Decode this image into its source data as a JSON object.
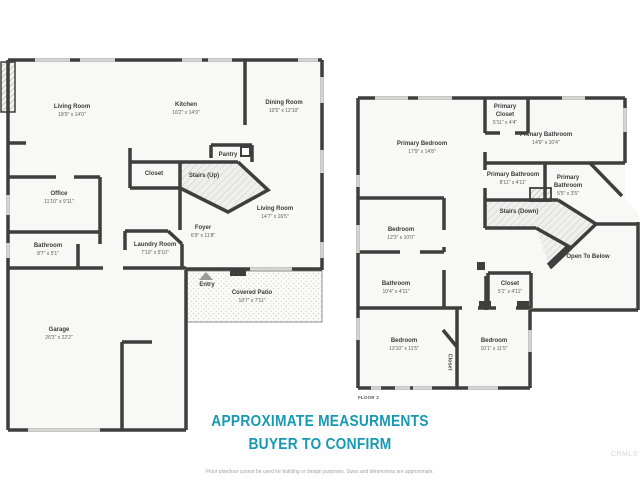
{
  "title": {
    "line1": "APPROXIMATE MEASURMENTS",
    "line2": "BUYER TO CONFIRM",
    "color": "#1899B2"
  },
  "disclaimer": "Floor plan/tour cannot be used for building or design purposes. Sizes and dimensions are approximate.",
  "watermark": "CRMLS",
  "colors": {
    "wall": "#3E3E3E",
    "window": "#D4D4D2",
    "floor": "#F8F8F7",
    "hatch": "#C9C9C9"
  },
  "floor1": {
    "label": "FLOOR 1",
    "rooms": [
      {
        "name": "Living Room",
        "dims": "18'9\" x 14'0\""
      },
      {
        "name": "Kitchen",
        "dims": "16'2\" x 14'9\""
      },
      {
        "name": "Dining Room",
        "dims": "10'5\" x 12'10\""
      },
      {
        "name": "Office",
        "dims": "11'10\" x 9'11\""
      },
      {
        "name": "Bathroom",
        "dims": "8'7\" x 5'1\""
      },
      {
        "name": "Laundry Room",
        "dims": "7'10\" x 5'10\""
      },
      {
        "name": "Closet"
      },
      {
        "name": "Stairs (Up)"
      },
      {
        "name": "Pantry"
      },
      {
        "name": "Foyer",
        "dims": "6'9\" x 11'8\""
      },
      {
        "name": "Living Room",
        "dims": "14'7\" x 16'5\""
      },
      {
        "name": "Entry"
      },
      {
        "name": "Covered Patio",
        "dims": "19'7\" x 7'11\""
      },
      {
        "name": "Garage",
        "dims": "26'3\" x 22'2\""
      }
    ]
  },
  "floor2": {
    "label": "FLOOR 2",
    "rooms": [
      {
        "name": "Primary Bedroom",
        "dims": "17'9\" x 14'8\""
      },
      {
        "name": "Primary Closet",
        "dims": "5'11\" x 4'4\""
      },
      {
        "name": "Primary Bathroom",
        "dims": "14'9\" x 10'4\""
      },
      {
        "name": "Primary Bathroom",
        "dims": "8'11\" x 4'11\""
      },
      {
        "name": "Primary Bathroom",
        "dims": "5'5\" x 3'5\""
      },
      {
        "name": "Stairs (Down)"
      },
      {
        "name": "Bedroom",
        "dims": "12'3\" x 10'0\""
      },
      {
        "name": "Bathroom",
        "dims": "10'4\" x 4'11\""
      },
      {
        "name": "Closet",
        "dims": "5'1\" x 4'11\""
      },
      {
        "name": "Open To Below"
      },
      {
        "name": "Bedroom",
        "dims": "13'10\" x 11'5\""
      },
      {
        "name": "Bedroom",
        "dims": "10'1\" x 11'5\""
      },
      {
        "name": "Closet"
      }
    ]
  }
}
